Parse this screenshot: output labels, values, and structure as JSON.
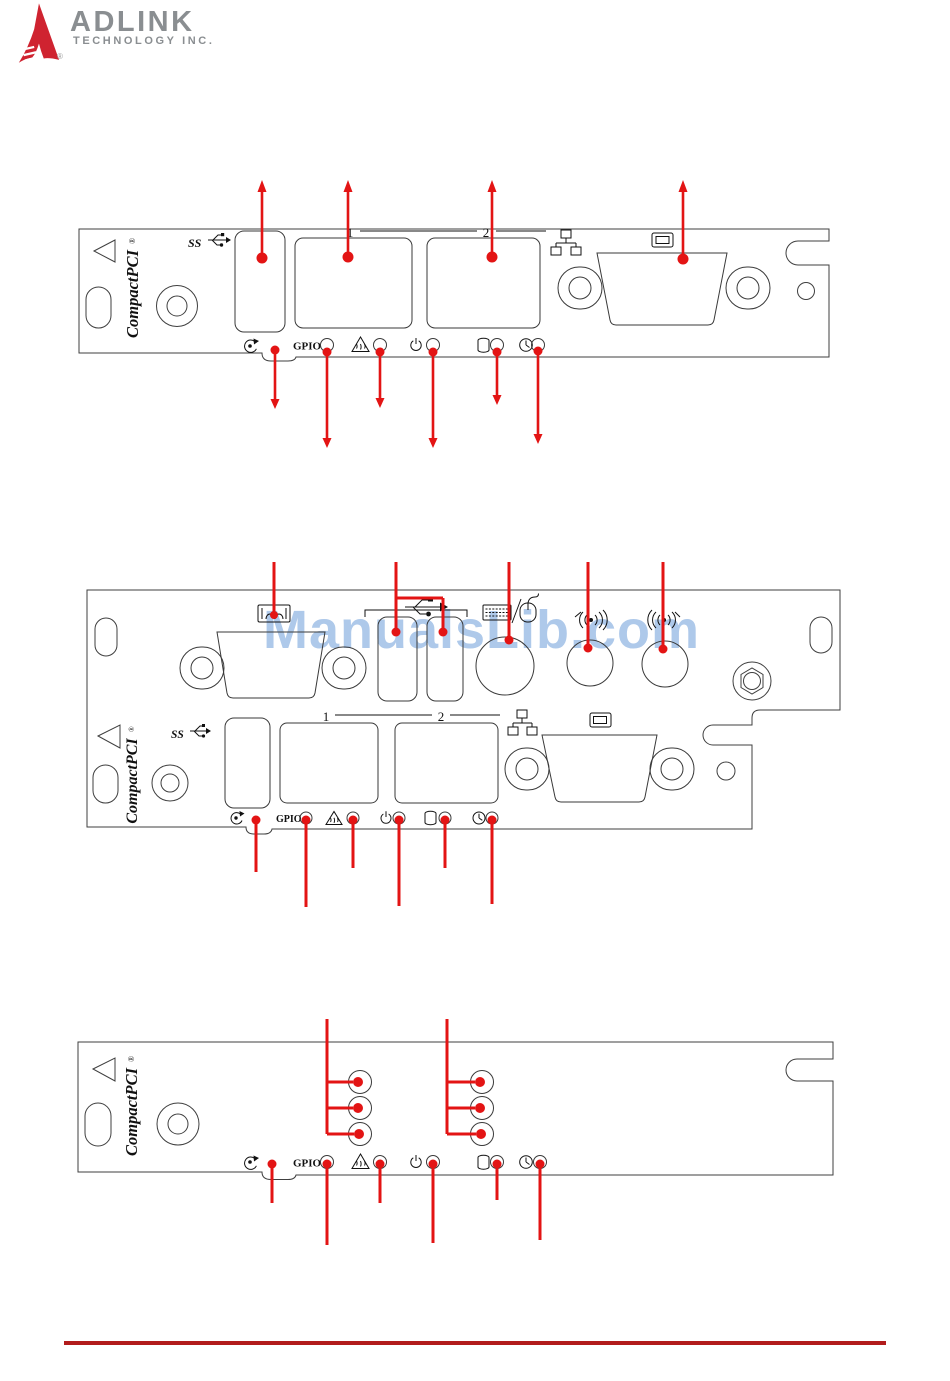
{
  "header": {
    "brand": "ADLINK",
    "brand_sub": "TECHNOLOGY INC.",
    "registered": "®"
  },
  "watermark": {
    "text": "ManualsLib.com"
  },
  "labels": {
    "brand": "CompactPCI",
    "reg": "®",
    "ss": "SS",
    "gpio": "GPIO",
    "lan1": "1",
    "lan2": "2"
  },
  "icons": {
    "usb3": "ss-usb-trident-icon",
    "usb": "usb-trident-icon",
    "ethernet": "ethernet-network-icon",
    "display": "display-monitor-icon",
    "serial": "serial-port-icon",
    "keyboard_mouse": "keyboard-mouse-icon",
    "antenna": "antenna-signal-icon",
    "reset": "reset-circular-arrow-icon",
    "overheat": "overheat-warning-triangle-icon",
    "power": "power-icon",
    "hdd": "hdd-cylinder-icon",
    "watchdog": "clock-icon"
  },
  "colors": {
    "annotation_red": "#e31414",
    "outline_gray": "#3f3f3f",
    "watermark_blue": "#aec9ea",
    "footer_rule_red": "#b21c1c",
    "logo_red": "#cf2330",
    "brand_gray": "#8a8e91"
  }
}
